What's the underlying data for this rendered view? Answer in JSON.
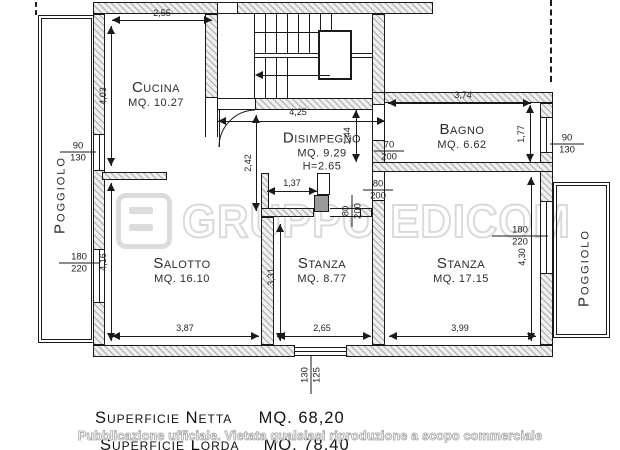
{
  "plan": {
    "rooms": {
      "cucina": {
        "name": "Cucina",
        "area": "MQ. 10.27"
      },
      "disimpegno": {
        "name": "Disimpegno",
        "area": "MQ. 9.29",
        "height": "H=2.65"
      },
      "bagno": {
        "name": "Bagno",
        "area": "MQ. 6.62"
      },
      "salotto": {
        "name": "Salotto",
        "area": "MQ. 16.10"
      },
      "stanza_centro": {
        "name": "Stanza",
        "area": "MQ. 8.77"
      },
      "stanza_destra": {
        "name": "Stanza",
        "area": "MQ. 17.15"
      },
      "poggiolo_sx": {
        "name": "Poggiolo"
      },
      "poggiolo_dx": {
        "name": "Poggiolo"
      }
    },
    "dimensions": {
      "cucina_larghezza": "2,55",
      "cucina_altezza": "4,03",
      "disimpegno_larghezza": "4,25",
      "disimpegno_altezza": "2,42",
      "disimpegno_dx": "1,44",
      "corridoio": "1,37",
      "bagno_larghezza": "3,74",
      "bagno_altezza": "1,77",
      "salotto_larghezza": "3,87",
      "salotto_altezza": "4,16",
      "stanza_centro_larghezza": "2,65",
      "stanza_centro_altezza": "3,31",
      "stanza_destra_larghezza": "3,99",
      "stanza_destra_altezza": "4,30"
    },
    "openings": {
      "finestra_cucina": {
        "w": "90",
        "h": "130"
      },
      "portafinestra_salotto": {
        "w": "180",
        "h": "220"
      },
      "porta_bagno": {
        "w": "70",
        "h": "200"
      },
      "porta_stanza_destra": {
        "w": "80",
        "h": "200"
      },
      "porta_stanza_centro": {
        "w": "80",
        "h": "200"
      },
      "finestra_bagno": {
        "w": "90",
        "h": "130"
      },
      "portafinestra_stanza_destra": {
        "w": "180",
        "h": "220"
      },
      "finestra_salotto_sud": {
        "w": "130",
        "h": "125"
      }
    }
  },
  "watermark": {
    "brand": "GRUPPO EDICOM"
  },
  "footer": {
    "net_label": "Superficie Netta",
    "net_value": "MQ. 68,20",
    "gross_label": "Superficie Lorda",
    "gross_value": "MQ. 78,40",
    "notice": "Pubblicazione ufficiale. Vietata qualsiasi riproduzione a scopo commerciale"
  }
}
